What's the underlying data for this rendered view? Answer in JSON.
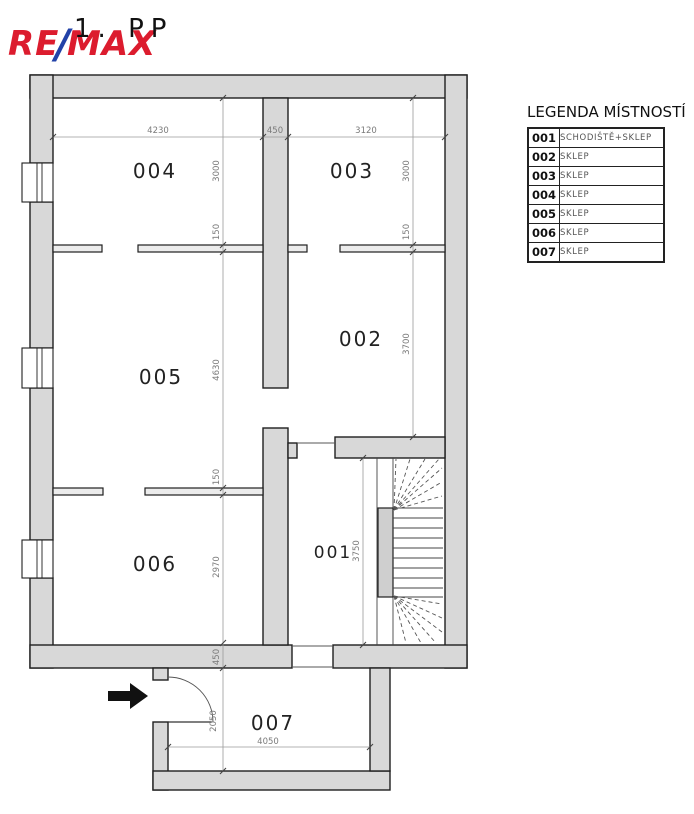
{
  "header": {
    "floor_label": "1. PP",
    "logo_re": "RE",
    "logo_slash": "/",
    "logo_max": "MAX"
  },
  "legend": {
    "title": "LEGENDA MÍSTNOSTÍ",
    "rows": [
      {
        "num": "001",
        "name": "SCHODIŠTĚ+SKLEP"
      },
      {
        "num": "002",
        "name": "SKLEP"
      },
      {
        "num": "003",
        "name": "SKLEP"
      },
      {
        "num": "004",
        "name": "SKLEP"
      },
      {
        "num": "005",
        "name": "SKLEP"
      },
      {
        "num": "006",
        "name": "SKLEP"
      },
      {
        "num": "007",
        "name": "SKLEP"
      }
    ]
  },
  "plan": {
    "room_labels": {
      "r001": "001",
      "r002": "002",
      "r003": "003",
      "r004": "004",
      "r005": "005",
      "r006": "006",
      "r007": "007"
    },
    "dims": {
      "top_w004": "4230",
      "top_wall": "450",
      "top_w003": "3120",
      "left_chain": [
        "3000",
        "150",
        "4630",
        "150",
        "2970",
        "450",
        "2050"
      ],
      "right_chain": [
        "3000",
        "150",
        "3700"
      ],
      "stair": "3750",
      "room007_width": "4050"
    },
    "colors": {
      "wall_fill": "#d8d8d8",
      "wall_stroke": "#1f1f1f",
      "dimension": "#8a8a8a",
      "logo_red": "#DC1C2E",
      "logo_blue": "#2242A8"
    }
  }
}
